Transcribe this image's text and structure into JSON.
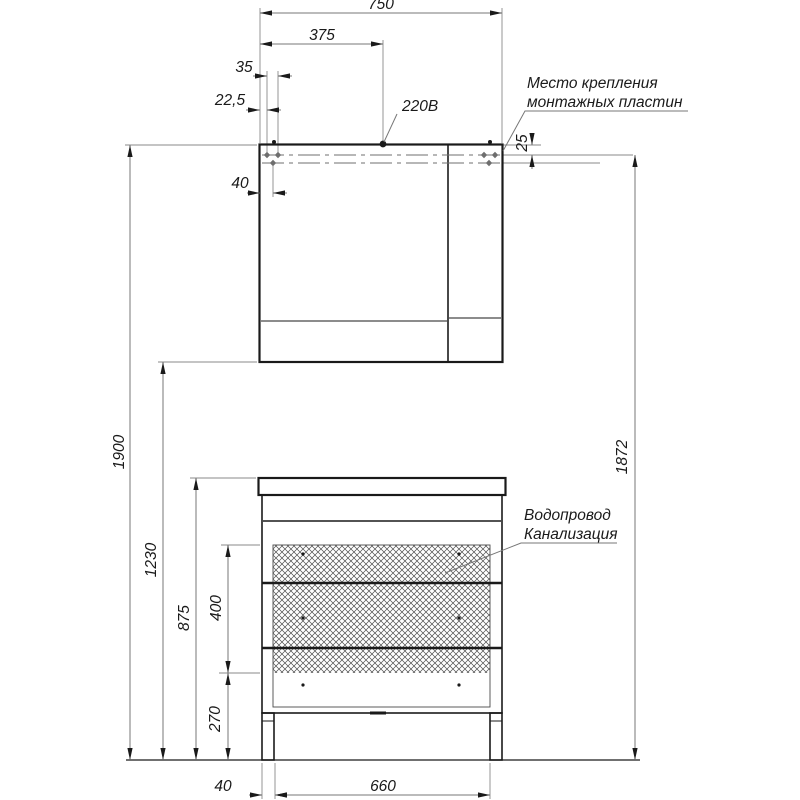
{
  "drawing": {
    "colors": {
      "line": "#1a1a1a",
      "dimension": "#777777",
      "background": "#ffffff"
    },
    "dimensions": {
      "total_width": "750",
      "half_width": "375",
      "plate_spacing": "35",
      "plate_edge_offset": "22,5",
      "plate_drop": "25",
      "plate_inset": "40",
      "total_height": "1900",
      "mirror_bottom_height": "1230",
      "vanity_height": "875",
      "opening_height": "400",
      "plinth_height": "270",
      "plate_height": "1872",
      "leg_inset": "40",
      "leg_span": "660"
    },
    "labels": {
      "power": "220В",
      "mounting_line1": "Место крепления",
      "mounting_line2": "монтажных пластин",
      "water_line1": "Водопровод",
      "water_line2": "Канализация"
    }
  }
}
